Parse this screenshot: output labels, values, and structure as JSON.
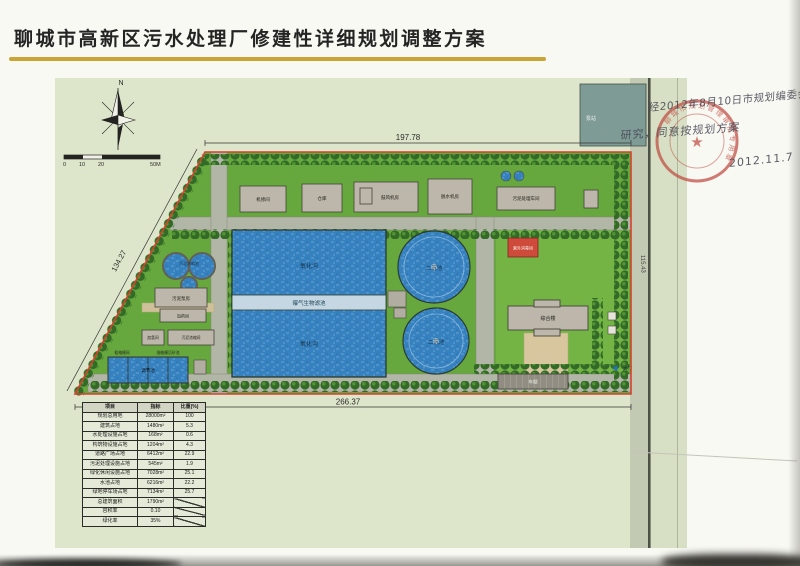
{
  "title": "聊城市高新区污水处理厂修建性详细规划调整方案",
  "colors": {
    "underline_gold": "#c9a42f",
    "boundary_red": "#d93a28",
    "water_blue": "#2f7fc2",
    "grass_green": "#61a737",
    "stamp_red": "#c0463c"
  },
  "compass": {
    "north": "N"
  },
  "scale_bar": {
    "t0": "0",
    "t1": "10",
    "t2": "20",
    "t3": "50M"
  },
  "dimensions": {
    "top": "197.78",
    "bottom": "266.37",
    "left": "134.27",
    "right": "115.43"
  },
  "site": {
    "north_parcel": "泵站",
    "gate": "大门",
    "gate_icon": "◀",
    "buildings": {
      "b1": "机修间",
      "b2": "仓库",
      "b3": "鼓风机房",
      "b4": "脱水机房",
      "b5": "污泥处理车间",
      "uv": "紫外消毒间",
      "office": "综合楼",
      "carport": "车棚",
      "sludge_pump": "污泥泵房",
      "dosing": "加药间",
      "chlorine": "加氯间",
      "thickening": "污泥浓缩间"
    },
    "pools": {
      "oxidation_top": "氧化沟",
      "aeration_channel": "曝气生物滤池",
      "oxidation_bottom": "氧化沟",
      "clarifier1": "二沉池",
      "clarifier2": "二沉池",
      "sludge_thickener": "污泥浓缩池",
      "inlet": "调节池",
      "screen_label": "粗格栅间",
      "grit_label": "细格栅沉砂池"
    }
  },
  "approval": {
    "line1": "经2012年8月10日市规划编委会议",
    "line2": "研究，同意按规划方案",
    "date": "2012.11.7",
    "stamp_text": "聊城市规划管理审批专用章",
    "stamp_star": "★"
  },
  "table": {
    "headers": [
      "项目",
      "指标",
      "比重(%)"
    ],
    "rows": [
      [
        "规划总用地",
        "28000m²",
        "100"
      ],
      [
        "建筑占地",
        "1480m²",
        "5.3"
      ],
      [
        "水处理设施占地",
        "168m²",
        "0.6"
      ],
      [
        "构筑物设施占地",
        "1204m²",
        "4.3"
      ],
      [
        "道路广场占地",
        "6412m²",
        "22.9"
      ],
      [
        "污泥处理设施占地",
        "545m²",
        "1.9"
      ],
      [
        "绿化休闲设施占地",
        "7028m²",
        "25.1"
      ],
      [
        "水池占地",
        "6216m²",
        "22.2"
      ],
      [
        "绿地停车场占地",
        "7134m²",
        "25.7"
      ],
      [
        "总建筑面积",
        "1790m²",
        ""
      ],
      [
        "容积率",
        "0.10",
        ""
      ],
      [
        "绿化率",
        "35%",
        ""
      ]
    ]
  }
}
